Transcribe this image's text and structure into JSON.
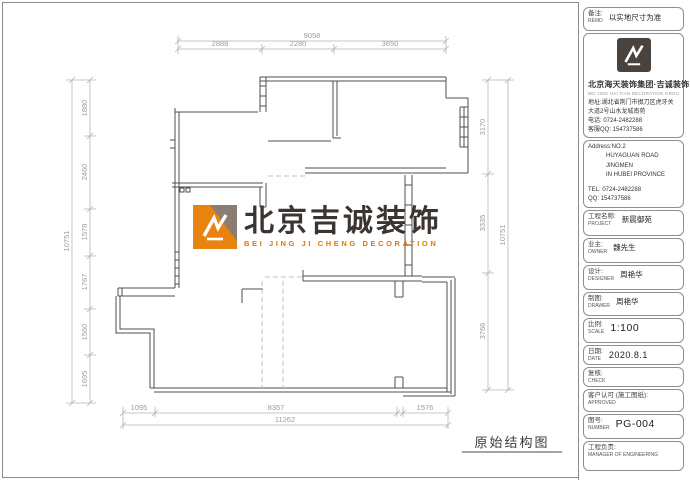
{
  "sheet": {
    "drawing_title": "原始结构图"
  },
  "watermark": {
    "name": "北京吉诚装饰",
    "subtitle": "BEI JING JI CHENG DECORATION"
  },
  "dims": {
    "top": {
      "overall": "9058",
      "segments": [
        "2888",
        "2280",
        "3650"
      ]
    },
    "bottom": {
      "overall": "11262",
      "segments": [
        "1095",
        "8357",
        "1576"
      ]
    },
    "left": {
      "overall": "10751",
      "segments": [
        "1880",
        "2460",
        "1578",
        "1767",
        "1560",
        "1695"
      ]
    },
    "right": {
      "overall": "10751",
      "segments": [
        "3170",
        "3335",
        "3766"
      ]
    }
  },
  "title_block": {
    "remark": {
      "label_cn": "备注:",
      "label_en": "REMD",
      "value": "以实地尺寸为准"
    },
    "company": {
      "name": "北京海天装饰集团·吉诚装饰",
      "tagline": "BEI JING HAI TIAN DECORATION GROUP JICHENG DECORATION",
      "address": "地址:湖北省荆门市掇刀区虎牙关大道2号山水龙城南苑",
      "phone": "电话: 0724-2482288",
      "qq": "客服QQ: 154737586"
    },
    "contact_en": {
      "address_line1": "Address:NO.2",
      "address_line2": "HUYAGUAN ROAD JINGMEN",
      "address_line3": "IN HUBEI PROVINCE",
      "tel": "TEL: 0724-2482288",
      "qq": "QQ: 154737586"
    },
    "fields": [
      {
        "label_cn": "工程名称:",
        "label_en": "PROJECT",
        "value": "新晨御苑"
      },
      {
        "label_cn": "业主:",
        "label_en": "OWNER",
        "value": "魏先生"
      },
      {
        "label_cn": "设计:",
        "label_en": "DESIGNER",
        "value": "周艳华"
      },
      {
        "label_cn": "制图:",
        "label_en": "DRAWER",
        "value": "周艳华"
      },
      {
        "label_cn": "比例:",
        "label_en": "SCALE",
        "value": "1:100"
      },
      {
        "label_cn": "日期:",
        "label_en": "DATE",
        "value": "2020.8.1"
      },
      {
        "label_cn": "复核:",
        "label_en": "CHECK",
        "value": ""
      },
      {
        "label_cn": "客户认可 (施工图纸):",
        "label_en": "APPROVED",
        "value": ""
      },
      {
        "label_cn": "图号:",
        "label_en": "NUMBER",
        "value": "PG-004"
      },
      {
        "label_cn": "工程负责:",
        "label_en": "MANAGER OF ENGINEERING",
        "value": ""
      }
    ]
  }
}
